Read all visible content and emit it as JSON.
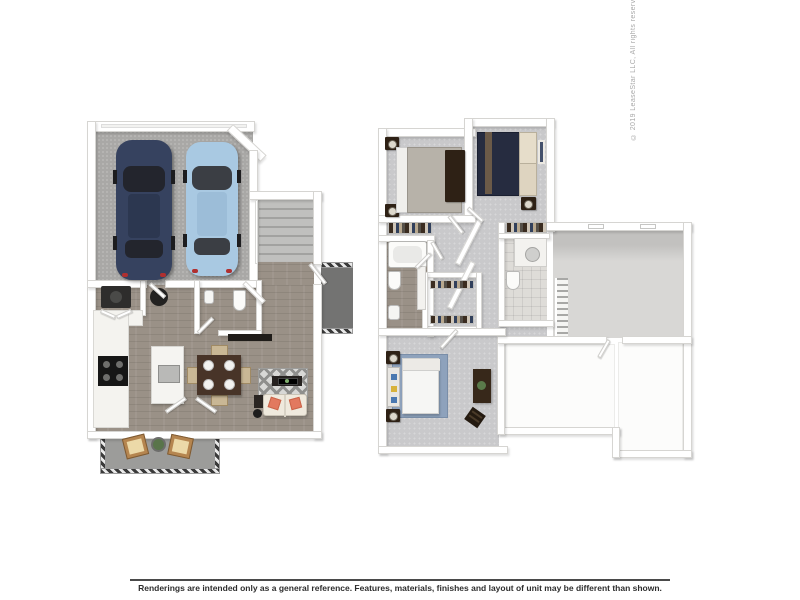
{
  "copyright": "© 2019 LeaseStar LLC, All rights reserved",
  "footer": {
    "disclaimer": "Renderings are intended only as a general reference. Features, materials, finishes and layout of unit may be different than shown."
  },
  "palette": {
    "background": "#ffffff",
    "wall": "#ffffff",
    "wall_edge": "#d6d5d2",
    "wood_floor": "#9a9187",
    "carpet": "#c9c9cb",
    "garage_concrete": "#a9a8a6",
    "stair_tread": "#a2a2a0",
    "patio_floor": "#9c9c9a",
    "stoop_floor": "#737372",
    "car_navy": "#36425f",
    "car_light_blue": "#a9c9e2",
    "car_glass": "#23252d",
    "sofa": "#efe9dd",
    "accent_pillow": "#e2795f",
    "dining_table": "#483428",
    "chair_beige": "#c9b795",
    "bed_navy": "#262c40",
    "master_rug_blue": "#8ea2bc",
    "dark_furniture": "#2e2115",
    "copyright_text": "#a8a8a8",
    "disclaimer_text": "#2d2d2d"
  }
}
